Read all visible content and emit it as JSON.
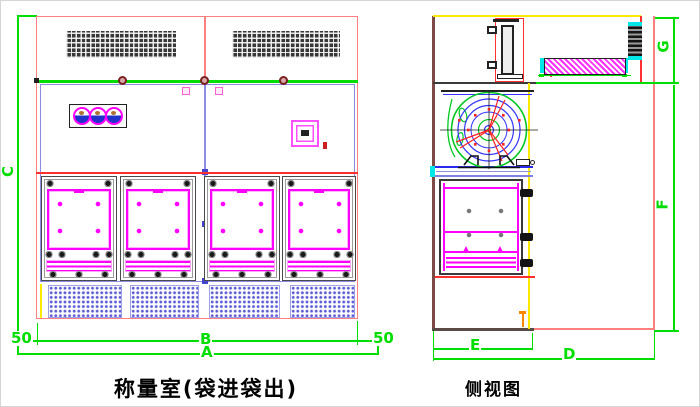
{
  "drawing": {
    "front_view": {
      "title": "称量室(袋进袋出)",
      "dim_height": "C",
      "dim_left_margin": "50",
      "dim_width_inner": "B",
      "dim_right_margin": "50",
      "dim_width_total": "A"
    },
    "side_view": {
      "title": "侧视图",
      "dim_top_height": "G",
      "dim_main_height": "F",
      "dim_depth_inner": "E",
      "dim_depth_total": "D"
    },
    "colors": {
      "outline_red": "#ff8080",
      "accent_red": "#ff3030",
      "dimension_green": "#00dd00",
      "detail_magenta": "#ff00ff",
      "structure_blue": "#8c8ce4",
      "grille_blue": "#5b5bd6",
      "highlight_yellow": "#ffe800",
      "fan_green": "#00c820",
      "ring_blue": "#3434ff",
      "cap_cyan": "#00e8e8",
      "hatch_dark": "#333333"
    }
  }
}
